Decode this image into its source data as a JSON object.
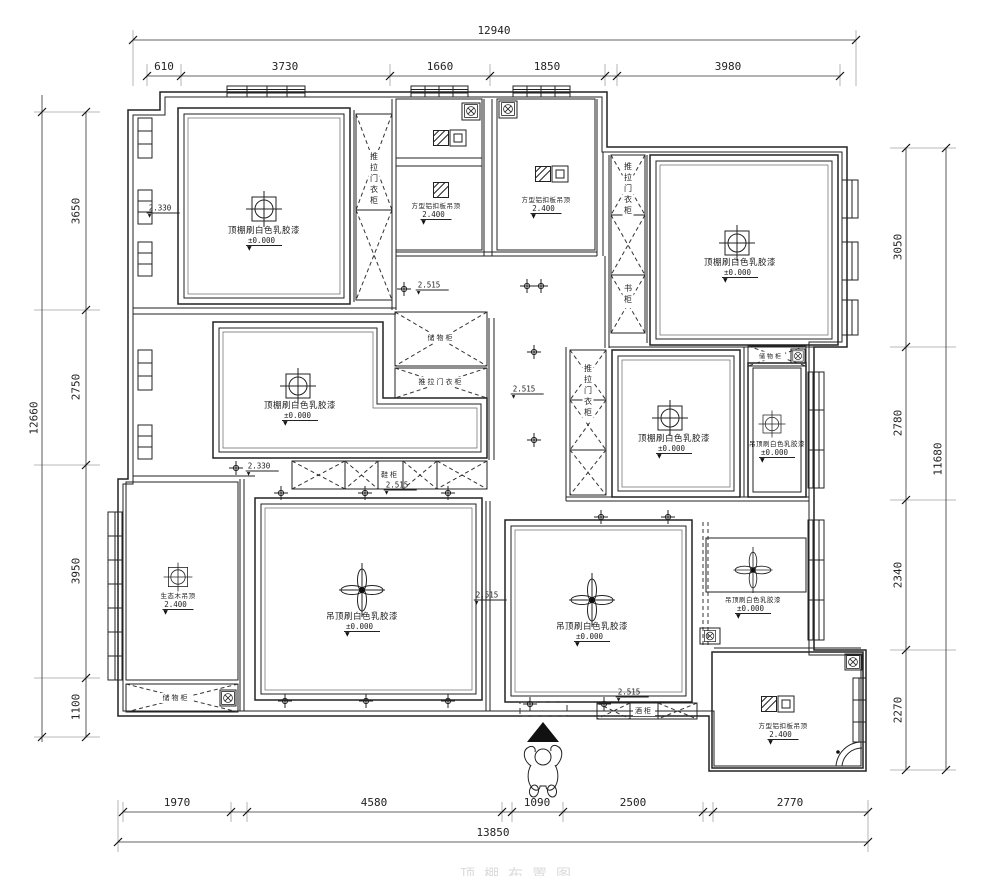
{
  "drawing": {
    "type": "ceiling-plan",
    "watermark_title": "顶棚布置图",
    "line_color": "#222222",
    "background": "#ffffff"
  },
  "dims": {
    "top": {
      "total": "12940",
      "segments": [
        "610",
        "3730",
        "1660",
        "1850",
        "3980"
      ]
    },
    "bottom": {
      "total": "13850",
      "segments": [
        "1970",
        "4580",
        "1090",
        "2500",
        "2770"
      ]
    },
    "left": {
      "total": "12660",
      "segments": [
        "3650",
        "2750",
        "3950",
        "1100"
      ]
    },
    "right": {
      "total": "11680",
      "segments": [
        "3050",
        "2780",
        "2340",
        "2270"
      ]
    }
  },
  "labels": {
    "ceiling_paint": "顶棚刷白色乳胶漆",
    "ceiling_paint_alt": "吊顶刷白色乳胶漆",
    "alu_ceiling": "方型铝扣板吊顶",
    "eco_wood": "生态木吊顶",
    "level_zero": "±0.000",
    "level_2400": "2.400",
    "level_2515": "2.515",
    "level_2330": "2.330",
    "wardrobe_sliding": "推拉门衣柜",
    "storage_cabinet": "储物柜",
    "shoe_cabinet": "鞋柜",
    "wine_cabinet": "酒柜",
    "bookcase": "书柜"
  },
  "icons": {
    "ceiling_lamp": "circle-in-square-with-cross",
    "chandelier": "four-petal-flower-cross",
    "downlight": "small-cross",
    "vent_fan": "circle-with-x-in-box",
    "exhaust_light": "hatched-square",
    "bath_heater": "dark-square-with-inset",
    "entry_arrow": "solid-triangle-up",
    "entry_person": "person-top-view"
  }
}
